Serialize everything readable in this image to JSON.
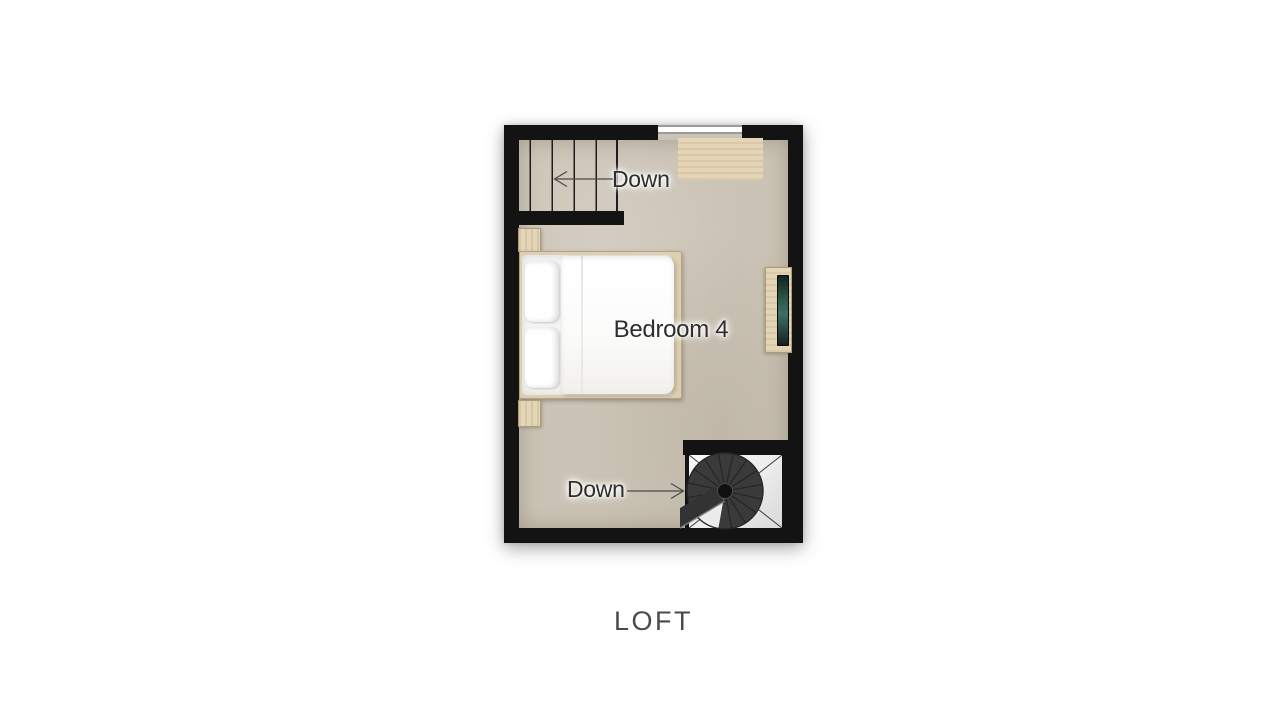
{
  "page": {
    "floor_title": "LOFT"
  },
  "plan": {
    "room_label": "Bedroom 4",
    "stairs_top": {
      "label": "Down",
      "arrow_direction": "left"
    },
    "stairs_spiral": {
      "label": "Down",
      "arrow_direction": "right"
    },
    "colors": {
      "wall": "#131313",
      "floor": "#cbc3b5",
      "wood": "#e4d5b7",
      "wood_border": "#ad9c7a",
      "void": "#f2f2f2",
      "spiral": "#3a3a3a",
      "label_text": "#2e2e2e",
      "glass_line": "#9a9a9a"
    }
  }
}
